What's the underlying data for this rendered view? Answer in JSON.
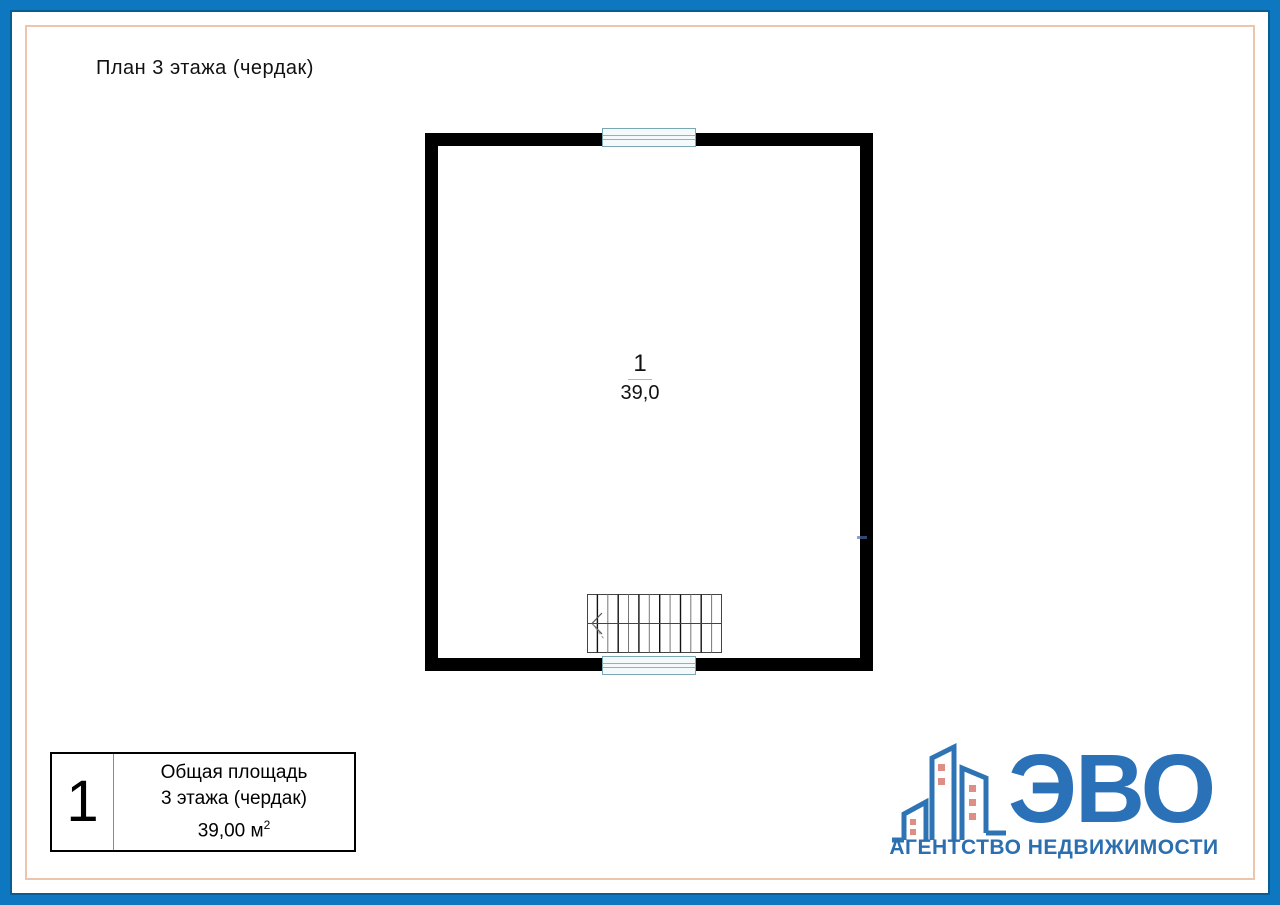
{
  "title": "План 3 этажа (чердак)",
  "plan": {
    "room_number": "1",
    "room_area": "39,0"
  },
  "legend": {
    "room_number": "1",
    "caption_line1": "Общая площадь",
    "caption_line2": "3 этажа (чердак)",
    "area_text": "39,00 м",
    "area_superscript": "2"
  },
  "logo": {
    "brand": "ЭВО",
    "tagline": "АГЕНТСТВО НЕДВИЖИМОСТИ"
  },
  "colors": {
    "frame_blue": "#0d77bf",
    "frame_blue_dark": "#0a5d94",
    "frame_accent_peach": "#eec4ad",
    "wall_black": "#000000",
    "window_line_teal": "#79a7b2",
    "window_fill": "#f4fafc",
    "logo_blue": "#2b71b8",
    "logo_window_salmon": "#dd8f85"
  }
}
